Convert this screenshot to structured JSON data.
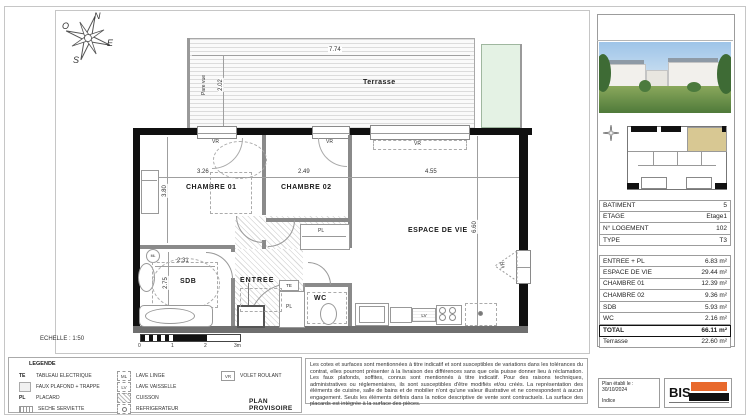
{
  "compass": {
    "n": "N",
    "e": "E",
    "s": "S",
    "o": "O"
  },
  "plan": {
    "terrasse": {
      "label": "Terrasse",
      "width": "7.74",
      "depth": "2.02",
      "pare_vue": "Pare vue"
    },
    "chambre1": {
      "label": "CHAMBRE 01",
      "width": "3.26",
      "depth": "3.80"
    },
    "chambre2": {
      "label": "CHAMBRE 02",
      "width": "2.49"
    },
    "espace_de_vie": {
      "label": "ESPACE DE VIE",
      "width": "4.55",
      "depth": "6.60"
    },
    "sdb": {
      "label": "SDB",
      "width": "2.31",
      "depth": "2.75"
    },
    "entree": {
      "label": "ENTREE"
    },
    "wc": {
      "label": "WC"
    },
    "tags": {
      "vr": "VR",
      "pl": "PL",
      "te": "TE",
      "ml": "ML",
      "lv": "LV"
    },
    "echelle": "ECHELLE : 1:50",
    "scale_ticks": [
      "0",
      "1",
      "2",
      "3m"
    ]
  },
  "side": {
    "table": {
      "info": [
        {
          "label": "BATIMENT",
          "value": "5"
        },
        {
          "label": "ETAGE",
          "value": "Etage1"
        },
        {
          "label": "N° LOGEMENT",
          "value": "102"
        },
        {
          "label": "TYPE",
          "value": "T3"
        }
      ],
      "areas": [
        {
          "label": "ENTREE + PL",
          "value": "6.83 m²"
        },
        {
          "label": "ESPACE DE VIE",
          "value": "29.44 m²"
        },
        {
          "label": "CHAMBRE 01",
          "value": "12.39 m²"
        },
        {
          "label": "CHAMBRE 02",
          "value": "9.36 m²"
        },
        {
          "label": "SDB",
          "value": "5.93 m²"
        },
        {
          "label": "WC",
          "value": "2.16 m²"
        }
      ],
      "total": {
        "label": "TOTAL",
        "value": "66.11 m²"
      },
      "terrasse": {
        "label": "Terrasse",
        "value": "22.60 m²"
      }
    }
  },
  "footer": {
    "legend": {
      "title": "LEGENDE",
      "col1": [
        {
          "sym": "TE",
          "label": "TABLEAU ELECTRIQUE"
        },
        {
          "sym": "",
          "label": "FAUX PLAFOND + TRAPPE"
        },
        {
          "sym": "PL",
          "label": "PLACARD"
        },
        {
          "sym": "",
          "label": "SECHE SERVIETTE"
        }
      ],
      "col2": [
        {
          "sym": "ML",
          "label": "LAVE LINGE"
        },
        {
          "sym": "LV",
          "label": "LAVE VAISSELLE"
        },
        {
          "sym": "",
          "label": "CUISSON"
        },
        {
          "sym": "",
          "label": "REFRIGERATEUR"
        }
      ],
      "col3": [
        {
          "sym": "VR",
          "label": "VOLET ROULANT"
        }
      ]
    },
    "plan_provisoire": "PLAN PROVISOIRE",
    "disclaimer": "Les cotes et surfaces sont mentionnées à titre indicatif et sont susceptibles de variations dans les tolérances du contrat, elles pourront présenter à la livraison des différences sans que cela puisse donner lieu à réclamation. Les faux plafonds, soffites, connus sont mentionnés à titre indicatif. Pour des raisons techniques, administratives ou réglementaires, ils sont susceptibles d'être modifiés et/ou créés. La représentation des éléments de cuisine, salle de bains et de mobilier n'ont qu'une valeur illustrative et ne correspondent à aucun engagement. Seuls les éléments définis dans la notice descriptive de vente sont contractuels. La surface des placards est intégrée à la surface des pièces.",
    "plan_info": {
      "label": "Plan établi le :",
      "date": "30/10/2024",
      "indice": "Indice"
    },
    "logo": {
      "text": "BIS"
    }
  },
  "colors": {
    "wall": "#101010",
    "partition": "#8a8a8a",
    "accent_orange": "#e8692c",
    "unit_highlight": "#d8c893",
    "terrace_green": "#e4f2e4"
  }
}
